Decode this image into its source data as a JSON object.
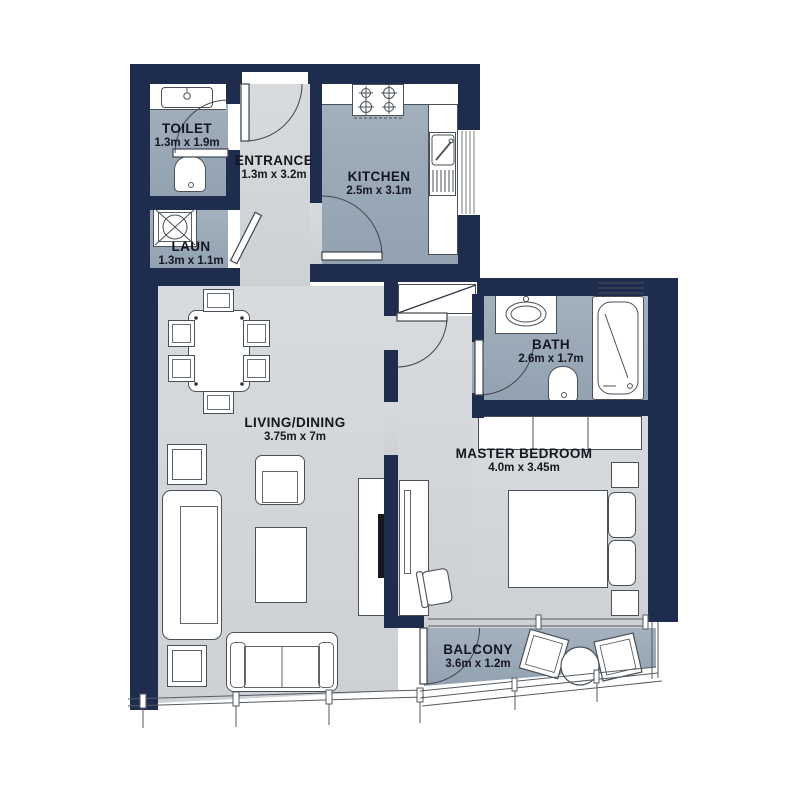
{
  "colors": {
    "wall": "#1e2c4e",
    "floor_light": "#d3d6d8",
    "floor_wet": "#9aa8b6",
    "outline": "#4a5058",
    "label_text": "#14171f"
  },
  "rooms": {
    "toilet": {
      "name": "TOILET",
      "dims": "1.3m x 1.9m",
      "fixtures": [
        "washbasin-icon",
        "wc-icon",
        "door-icon"
      ]
    },
    "entrance": {
      "name": "ENTRANCE",
      "dims": "1.3m x 3.2m",
      "fixtures": [
        "entry-door-icon"
      ]
    },
    "kitchen": {
      "name": "KITCHEN",
      "dims": "2.5m x 3.1m",
      "fixtures": [
        "stove-icon",
        "kitchen-sink-icon",
        "window-icon",
        "door-icon"
      ]
    },
    "laundry": {
      "name": "LAUN",
      "dims": "1.3m x 1.1m",
      "fixtures": [
        "washing-machine-icon",
        "door-icon"
      ]
    },
    "living": {
      "name": "LIVING/DINING",
      "dims": "3.75m x 7m",
      "fixtures": [
        "dining-table-icon",
        "dining-chair-icon",
        "sofa-icon",
        "loveseat-icon",
        "armchair-icon",
        "coffee-table-icon",
        "side-table-icon",
        "tv-console-icon",
        "tv-icon",
        "window-wall-icon"
      ]
    },
    "bath": {
      "name": "BATH",
      "dims": "2.6m x 1.7m",
      "fixtures": [
        "washbasin-icon",
        "bathtub-icon",
        "wc-icon",
        "shelf-icon",
        "door-icon"
      ]
    },
    "bedroom": {
      "name": "MASTER BEDROOM",
      "dims": "4.0m x 3.45m",
      "fixtures": [
        "wardrobe-icon",
        "double-bed-icon",
        "pillow-icon",
        "nightstand-icon",
        "desk-icon",
        "desk-chair-icon",
        "closet-icon"
      ]
    },
    "balcony": {
      "name": "BALCONY",
      "dims": "3.6m x 1.2m",
      "fixtures": [
        "balcony-chair-icon",
        "round-table-icon",
        "railing-icon",
        "door-icon"
      ]
    }
  }
}
